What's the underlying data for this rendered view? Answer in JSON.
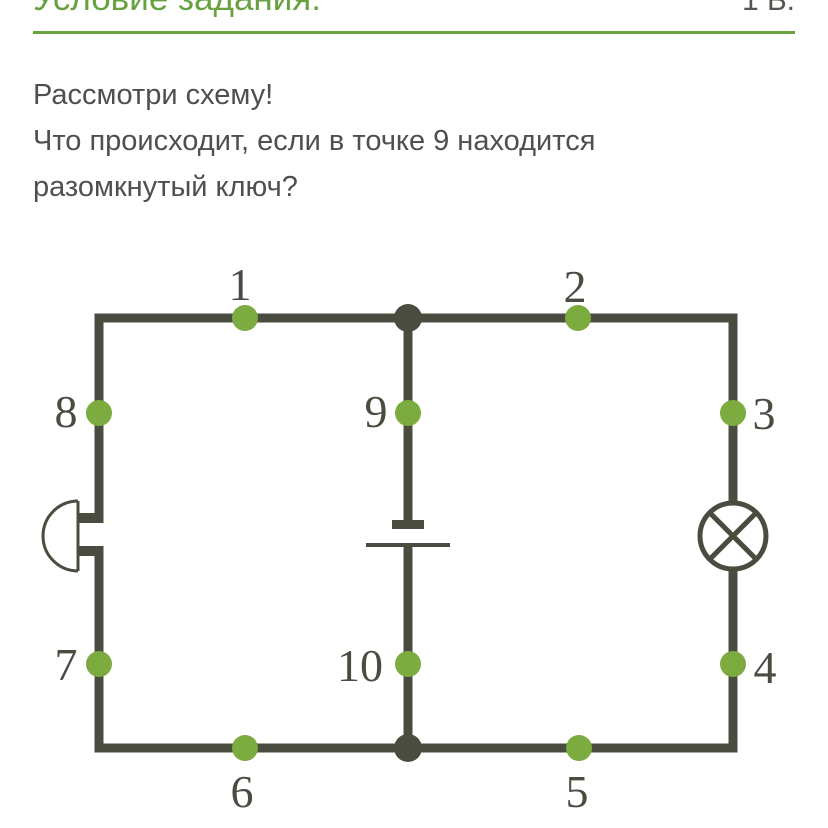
{
  "header": {
    "title": "Условие задания:",
    "points_label": "1 Б.",
    "accent_color": "#67a23f"
  },
  "task": {
    "lines": [
      "Рассмотри схему!",
      "Что происходит, если в точке 9 находится",
      "разомкнутый ключ?"
    ]
  },
  "circuit": {
    "colors": {
      "wire": "#4b4c40",
      "dot": "#7cab40"
    },
    "points": [
      {
        "label": "1"
      },
      {
        "label": "2"
      },
      {
        "label": "3"
      },
      {
        "label": "4"
      },
      {
        "label": "5"
      },
      {
        "label": "6"
      },
      {
        "label": "7"
      },
      {
        "label": "8"
      },
      {
        "label": "9"
      },
      {
        "label": "10"
      }
    ],
    "components": [
      {
        "icon": "bell-icon",
        "type": "electric-bell",
        "position": "left-branch"
      },
      {
        "icon": "battery-icon",
        "type": "battery-cell",
        "position": "middle-branch"
      },
      {
        "icon": "lamp-icon",
        "type": "lamp",
        "position": "right-branch"
      }
    ]
  }
}
